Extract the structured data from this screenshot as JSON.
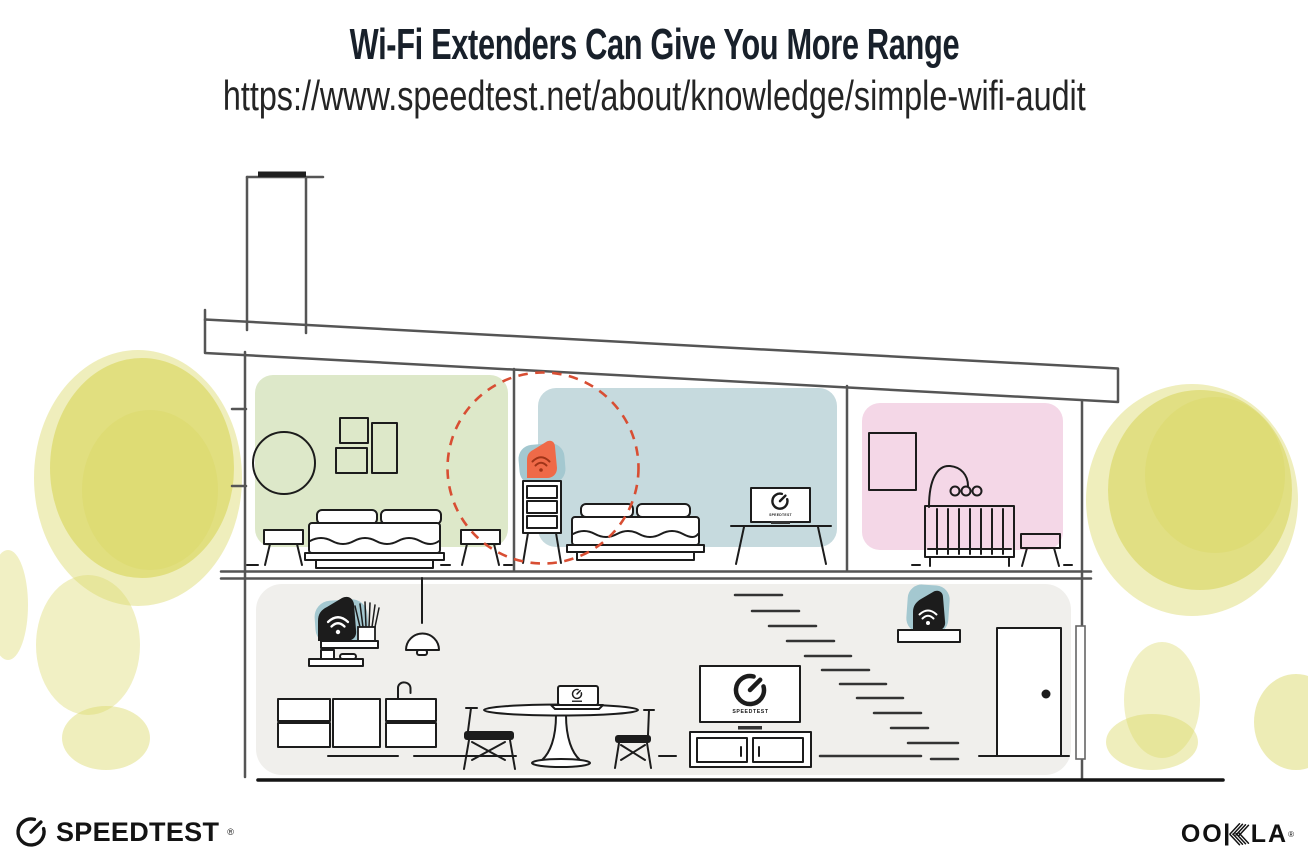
{
  "header": {
    "title": "Wi-Fi Extenders Can Give You More Range",
    "subtitle_url": "https://www.speedtest.net/about/knowledge/simple-wifi-audit"
  },
  "illustration": {
    "description": "Cross-section of a two-story house showing Wi-Fi router and extender placement",
    "tv_label": "SPEEDTEST",
    "coverage_highlight": "red dashed circle around upstairs wifi extender",
    "icons": [
      "wifi-icon",
      "speedtest-gauge-icon",
      "ookla-hatched-k-icon"
    ],
    "devices": [
      {
        "id": "wifi-router",
        "location": "downstairs wall shelf",
        "style": "black on teal blob"
      },
      {
        "id": "wifi-extender-upstairs",
        "location": "dresser in middle bedroom",
        "style": "orange on teal blob",
        "highlighted": true
      },
      {
        "id": "wifi-extender-stairs",
        "location": "shelf above stairs",
        "style": "black on teal blob"
      }
    ],
    "rooms": [
      {
        "name": "bedroom-left",
        "wall_color": "green",
        "items": [
          "round-mirror",
          "three-wall-frames",
          "double-bed",
          "two-nightstands"
        ]
      },
      {
        "name": "bedroom-middle",
        "wall_color": "blue",
        "items": [
          "dresser",
          "wifi-extender",
          "double-bed",
          "tv-on-stand"
        ]
      },
      {
        "name": "nursery-right",
        "wall_color": "pink",
        "items": [
          "wall-frame",
          "baby-mobile",
          "crib",
          "stool"
        ]
      },
      {
        "name": "downstairs-living-area",
        "wall_color": "gray",
        "items": [
          "wifi-router-shelf",
          "plant",
          "wall-shelf",
          "pendant-lamp",
          "kitchen-cabinets",
          "faucet",
          "dining-table",
          "laptop",
          "two-chairs",
          "tv",
          "media-console",
          "stairs",
          "extender-shelf",
          "door"
        ]
      }
    ],
    "exterior": [
      "chimney",
      "slanted-roof",
      "yellow-watercolor-trees-left",
      "yellow-watercolor-trees-right"
    ]
  },
  "footer": {
    "speedtest_text": "SPEEDTEST",
    "speedtest_registered": "®",
    "ookla_text": "OOKLA",
    "ookla_oo": "OO",
    "ookla_la": "LA",
    "ookla_registered": "®"
  },
  "palette": {
    "room-green": "#dde8c9",
    "room-blue": "#c6dade",
    "room-pink": "#f4d7e7",
    "device-teal": "#a4c8d0",
    "device-orange": "#ef6a48",
    "wifi-dark-red": "#a03418",
    "coverage-red": "#d84e33",
    "floor-gray": "#f0efec",
    "line-dark": "#1c1c1c",
    "line-structure": "#555555",
    "tree-yellow": "#dcd96b",
    "title-dark": "#18202a"
  }
}
